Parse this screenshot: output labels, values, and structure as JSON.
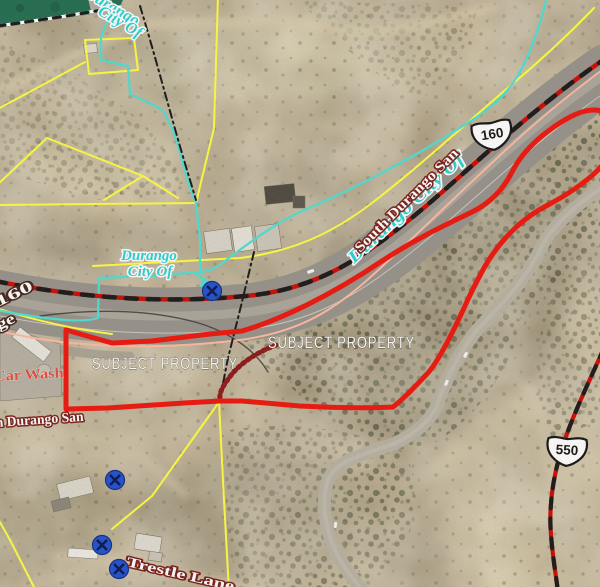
{
  "map": {
    "type": "aerial-parcel-map",
    "labels": {
      "subject_property_left": "SUBJECT PROPERTY",
      "subject_property_right": "SUBJECT PROPERTY",
      "city_top_line1": "Durango",
      "city_top_line2": "City Of",
      "city_center_line1": "Durango",
      "city_center_line2": "City Of",
      "city_highway": "Durango City Of",
      "street_south_durango_san": "South Durango San",
      "street_n_durango_san": "n Durango San",
      "street_trestle_lane": "Trestle Lane",
      "street_frontage_frag1": "160",
      "street_frontage_frag2": "ge",
      "poi_car_wash": "Car Wash"
    },
    "shields": {
      "us160": "160",
      "us550": "550"
    },
    "markers": {
      "type": "crossing-marker",
      "count": 4
    },
    "colors": {
      "subject_boundary": "#ee1209",
      "parcel_yellow": "#ffff3d",
      "city_limits_cyan": "#49e0d6",
      "right_of_way_pink": "#ffb9a2",
      "centerline_red": "#cc0700",
      "centerline_black": "#151515",
      "railroad_maroon": "#8b1616",
      "marker_blue": "#1d4fd0",
      "city_green": "#1f6b4e"
    }
  }
}
